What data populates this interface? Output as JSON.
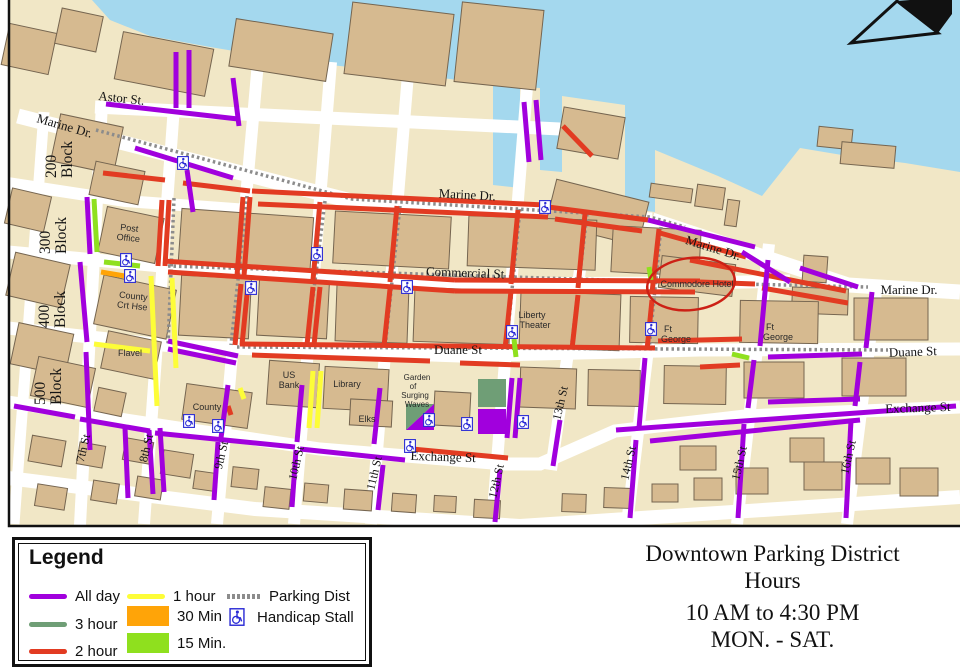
{
  "colors": {
    "all_day": "#a100dd",
    "one_hour": "#fdfd38",
    "two_hour": "#e23b22",
    "three_hour": "#6f9e76",
    "thirty_min": "#ffa408",
    "fifteen_min": "#8fe01e",
    "parking_dist": "#8c8c8c",
    "water": "#a4d8ee",
    "land": "#f1e7c6",
    "building": "#d6ba90",
    "building_outline": "#756550",
    "handicap": "#2b2bd5",
    "annotation_red": "#cc2015"
  },
  "legend": {
    "title": "Legend",
    "all_day": "All day",
    "three_hour": "3 hour",
    "two_hour": "2 hour",
    "one_hour": "1 hour",
    "thirty_min": "30 Min",
    "fifteen_min": "15 Min.",
    "parking_dist": "Parking Dist",
    "handicap": "Handicap Stall"
  },
  "title_block": {
    "line1": "Downtown Parking District",
    "line2": "Hours",
    "line3": "10 AM to 4:30 PM",
    "line4": "MON. - SAT."
  },
  "map": {
    "streets": {
      "astor": "Astor St.",
      "marine": "Marine Dr.",
      "commercial": "Commercial St",
      "duane": "Duane St",
      "exchange": "Exchange St",
      "s7": "7th St",
      "s8": "8th St",
      "s9": "9th St",
      "s10": "10th St",
      "s11": "11th St",
      "s12": "12th St",
      "s13": "13th St",
      "s14": "14th St",
      "s15": "15th St",
      "s16": "16th St"
    },
    "blocks": {
      "b200": [
        "200",
        "Block"
      ],
      "b300": [
        "300",
        "Block"
      ],
      "b400": [
        "400",
        "Block"
      ],
      "b500": [
        "500",
        "Block"
      ]
    },
    "places": {
      "post_office": [
        "Post",
        "Office"
      ],
      "county_crt": [
        "County",
        "Crt Hse"
      ],
      "flavel": "Flavel",
      "county": "County",
      "us_bank": [
        "US",
        "Bank"
      ],
      "library": "Library",
      "elks": "Elks",
      "garden": [
        "Garden",
        "of",
        "Surging",
        "Waves"
      ],
      "liberty": [
        "Liberty",
        "Theater"
      ],
      "commodore": "Commodore Hotel",
      "ft_george": [
        "Ft",
        "George"
      ]
    }
  }
}
